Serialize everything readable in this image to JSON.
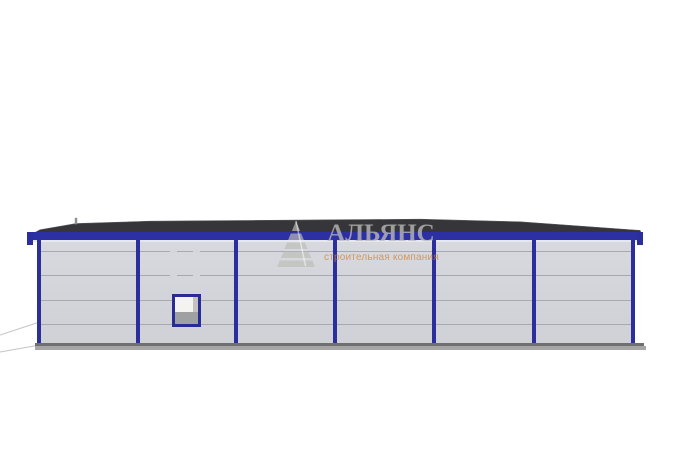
{
  "page": {
    "background": "#ffffff",
    "description": "Front elevation 3D render of a prefabricated steel warehouse building"
  },
  "watermark": {
    "brand": "АЛЬЯНС",
    "tagline": "строительная компания",
    "logo": "striped-pyramid-logo",
    "brand_color": "rgba(188,188,184,0.78)",
    "tagline_color": "rgba(210,130,55,0.75)"
  },
  "building": {
    "bays": 6,
    "columns_count": 7,
    "panel_rows": 5,
    "columns_x": [
      37,
      135.5,
      234,
      333,
      432,
      531.5,
      631
    ],
    "panel_lines_y": [
      250.5,
      275,
      299.5,
      324
    ],
    "dash_gaps": [
      {
        "x": 170,
        "y": 249.5
      },
      {
        "x": 193,
        "y": 249.5
      },
      {
        "x": 170,
        "y": 274
      },
      {
        "x": 193,
        "y": 274
      }
    ],
    "window": {
      "bay": 2,
      "x": 172,
      "y": 294,
      "w": 29,
      "h": 33
    },
    "colors": {
      "frame_blue": "#2b2f9e",
      "beam_blue": "#2c30a2",
      "wall_gray": "#d4d6db",
      "panel_line_gray": "#a7a9b0",
      "roof_dark": "#35353a",
      "plinth_gray": "#a6a6a6",
      "plinth_edge": "#6f6f6f",
      "window_pane": "#f4f3ef",
      "window_shadow": "#9fa0a2"
    }
  }
}
